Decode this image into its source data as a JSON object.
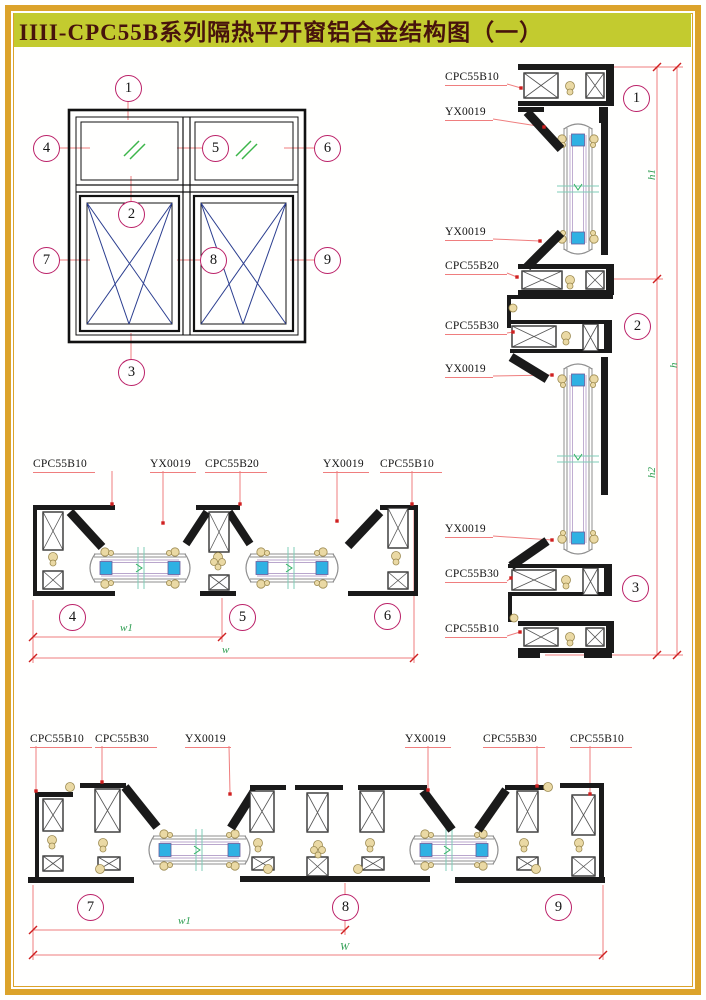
{
  "title": "IIII-CPC55B系列隔热平开窗铝合金结构图（一）",
  "colors": {
    "title_bg": "#c3cb2f",
    "title_text": "#47130c",
    "sheet_border": "#dca32b",
    "callout_ring": "#bb2168",
    "leader_line": "#ef7e7e",
    "dim_text": "#2f9e52",
    "glass_spacer_blue": "#2fb1e3",
    "profile_black": "#1a1a1a",
    "gasket_beige": "#ead9a4",
    "open_symbol_blue": "#2a3d8f",
    "glass_mark_green": "#3cb54a"
  },
  "elevation": {
    "callouts": [
      "1",
      "2",
      "3",
      "4",
      "5",
      "6",
      "7",
      "8",
      "9"
    ]
  },
  "vsection": {
    "labels": [
      "CPC55B10",
      "YX0019",
      "YX0019",
      "CPC55B20",
      "CPC55B30",
      "YX0019",
      "YX0019",
      "CPC55B30",
      "CPC55B10"
    ],
    "callouts": [
      "1",
      "2",
      "3"
    ],
    "dims": {
      "h1": "h1",
      "h": "h",
      "h2": "h2"
    }
  },
  "hsection_mid": {
    "labels": [
      "CPC55B10",
      "YX0019",
      "CPC55B20",
      "YX0019",
      "CPC55B10"
    ],
    "callouts": [
      "4",
      "5",
      "6"
    ],
    "dims": {
      "w1": "w1",
      "w": "w"
    }
  },
  "hsection_bottom": {
    "labels": [
      "CPC55B10",
      "CPC55B30",
      "YX0019",
      "YX0019",
      "CPC55B30",
      "CPC55B10"
    ],
    "callouts": [
      "7",
      "8",
      "9"
    ],
    "dims": {
      "w1": "w1",
      "w": "W"
    }
  }
}
